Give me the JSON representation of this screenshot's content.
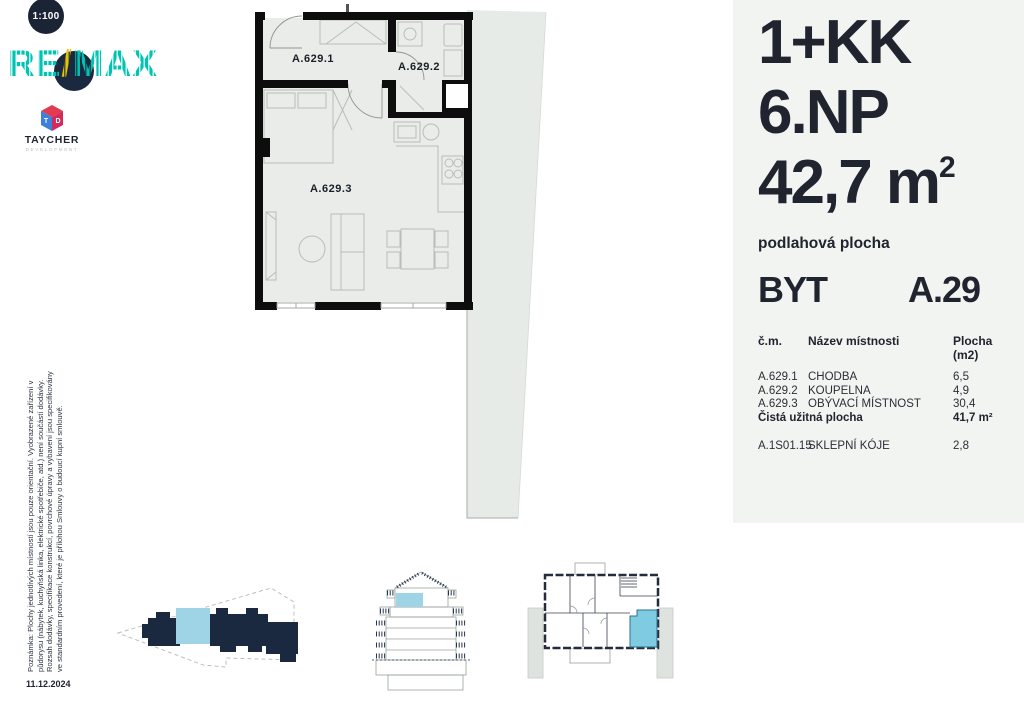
{
  "scale_badge": {
    "label": "1:100"
  },
  "brand": {
    "remax_re": "RE",
    "remax_slash": "/",
    "remax_max": "MAX",
    "taycher": {
      "cube_t": "T",
      "cube_d": "D",
      "name": "TAYCHER",
      "subtitle": "DEVELOPMENT"
    }
  },
  "floor_plan": {
    "room_labels": [
      "A.629.1",
      "A.629.2",
      "A.629.3"
    ]
  },
  "panel": {
    "layout": "1+KK",
    "floor": "6.NP",
    "area": {
      "value": "42,7",
      "unit": "m",
      "sup": "2"
    },
    "area_caption": "podlahová plocha",
    "unit": {
      "type": "BYT",
      "id": "A.29"
    },
    "table": {
      "col_room": "č.m.",
      "col_name": "Název místnosti",
      "col_area": "Plocha (m2)",
      "rows": [
        {
          "id": "A.629.1",
          "name": "CHODBA",
          "area": "6,5"
        },
        {
          "id": "A.629.2",
          "name": "KOUPELNA",
          "area": "4,9"
        },
        {
          "id": "A.629.3",
          "name": "OBÝVACÍ MÍSTNOST",
          "area": "30,4"
        }
      ],
      "total": {
        "label": "Čistá užitná plocha",
        "value": "41,7 m²"
      },
      "cellar": {
        "id": "A.1S01.15",
        "name": "SKLEPNÍ KÓJE",
        "area": "2,8"
      }
    }
  },
  "note": {
    "line1": "Poznámka: Plochy jednotlivých místností jsou pouze orientační. Vyobrazené zařízení v",
    "line2": "půdorysu (nábytek, kuchyňská linka, elektrické spotřebiče, atd.) není součástí dodávky.",
    "line3": "Rozsah dodávky, specifikace konstrukcí, povrchové úpravy a vybavení jsou specifikovány",
    "line4": "ve standardním provedení, které je přílohou Smlouvy o budoucí kupní smlouvě.",
    "date": "11.12.2024"
  },
  "colors": {
    "teal": "#00c3b2",
    "navy": "#1b2940",
    "gold": "#e8c400",
    "highlight_blue": "#9fd3e6",
    "panel_bg": "#f2f4f1",
    "plan_fill": "#e9ece8",
    "wall": "#0d0d0d"
  }
}
